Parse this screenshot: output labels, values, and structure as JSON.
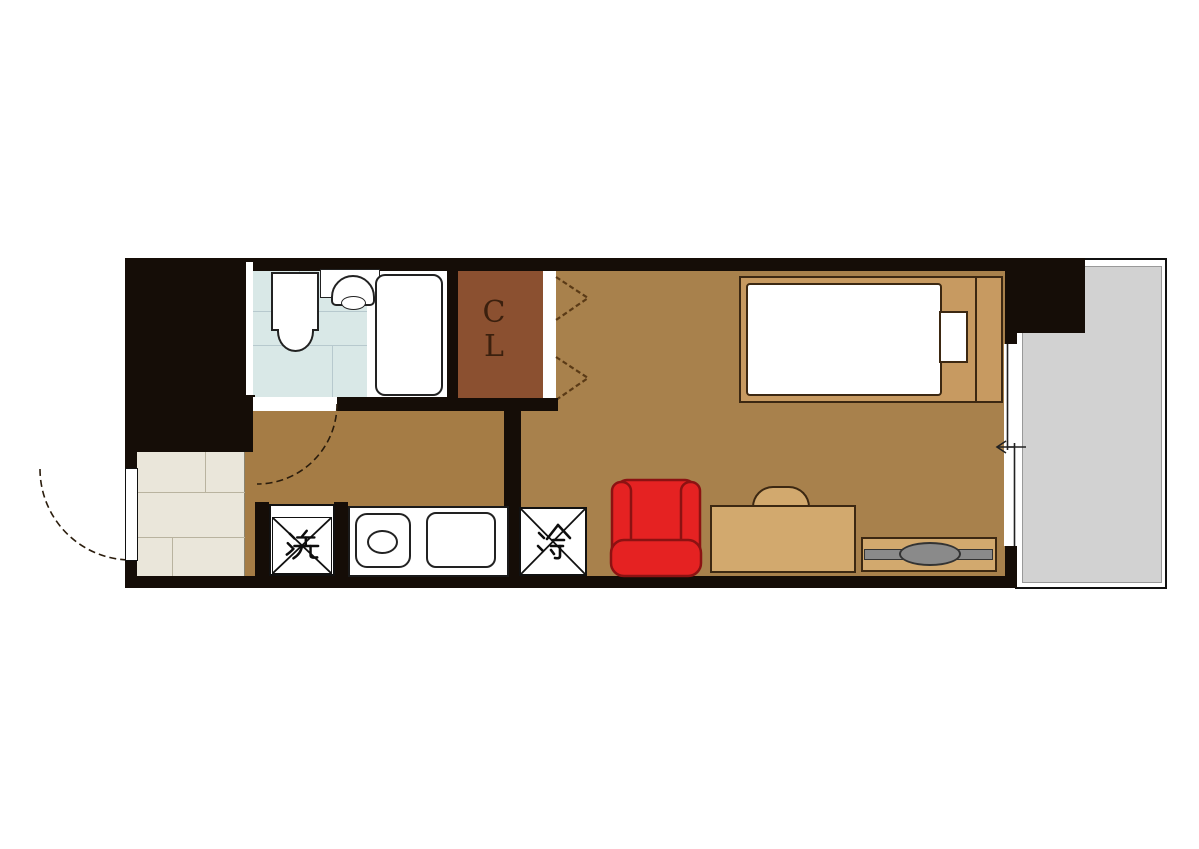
{
  "plan": {
    "type_label": "apartment-floor-plan",
    "closet_label": "CL",
    "washer_label": "洗",
    "fridge_label": "冷"
  },
  "colors": {
    "wall": "#150d07",
    "room_floor": "#a8814c",
    "hall_floor": "#a57c45",
    "closet_floor": "#8b5030",
    "bath_floor": "#d9e8e7",
    "entry_floor": "#eae6da",
    "balcony_floor": "#d2d2d2",
    "bed_frame": "#c79a61",
    "desk": "#d2a96e",
    "accent_red": "#e52222",
    "accent_red_dark": "#8c1212",
    "tv_gray": "#8a8a8a"
  }
}
